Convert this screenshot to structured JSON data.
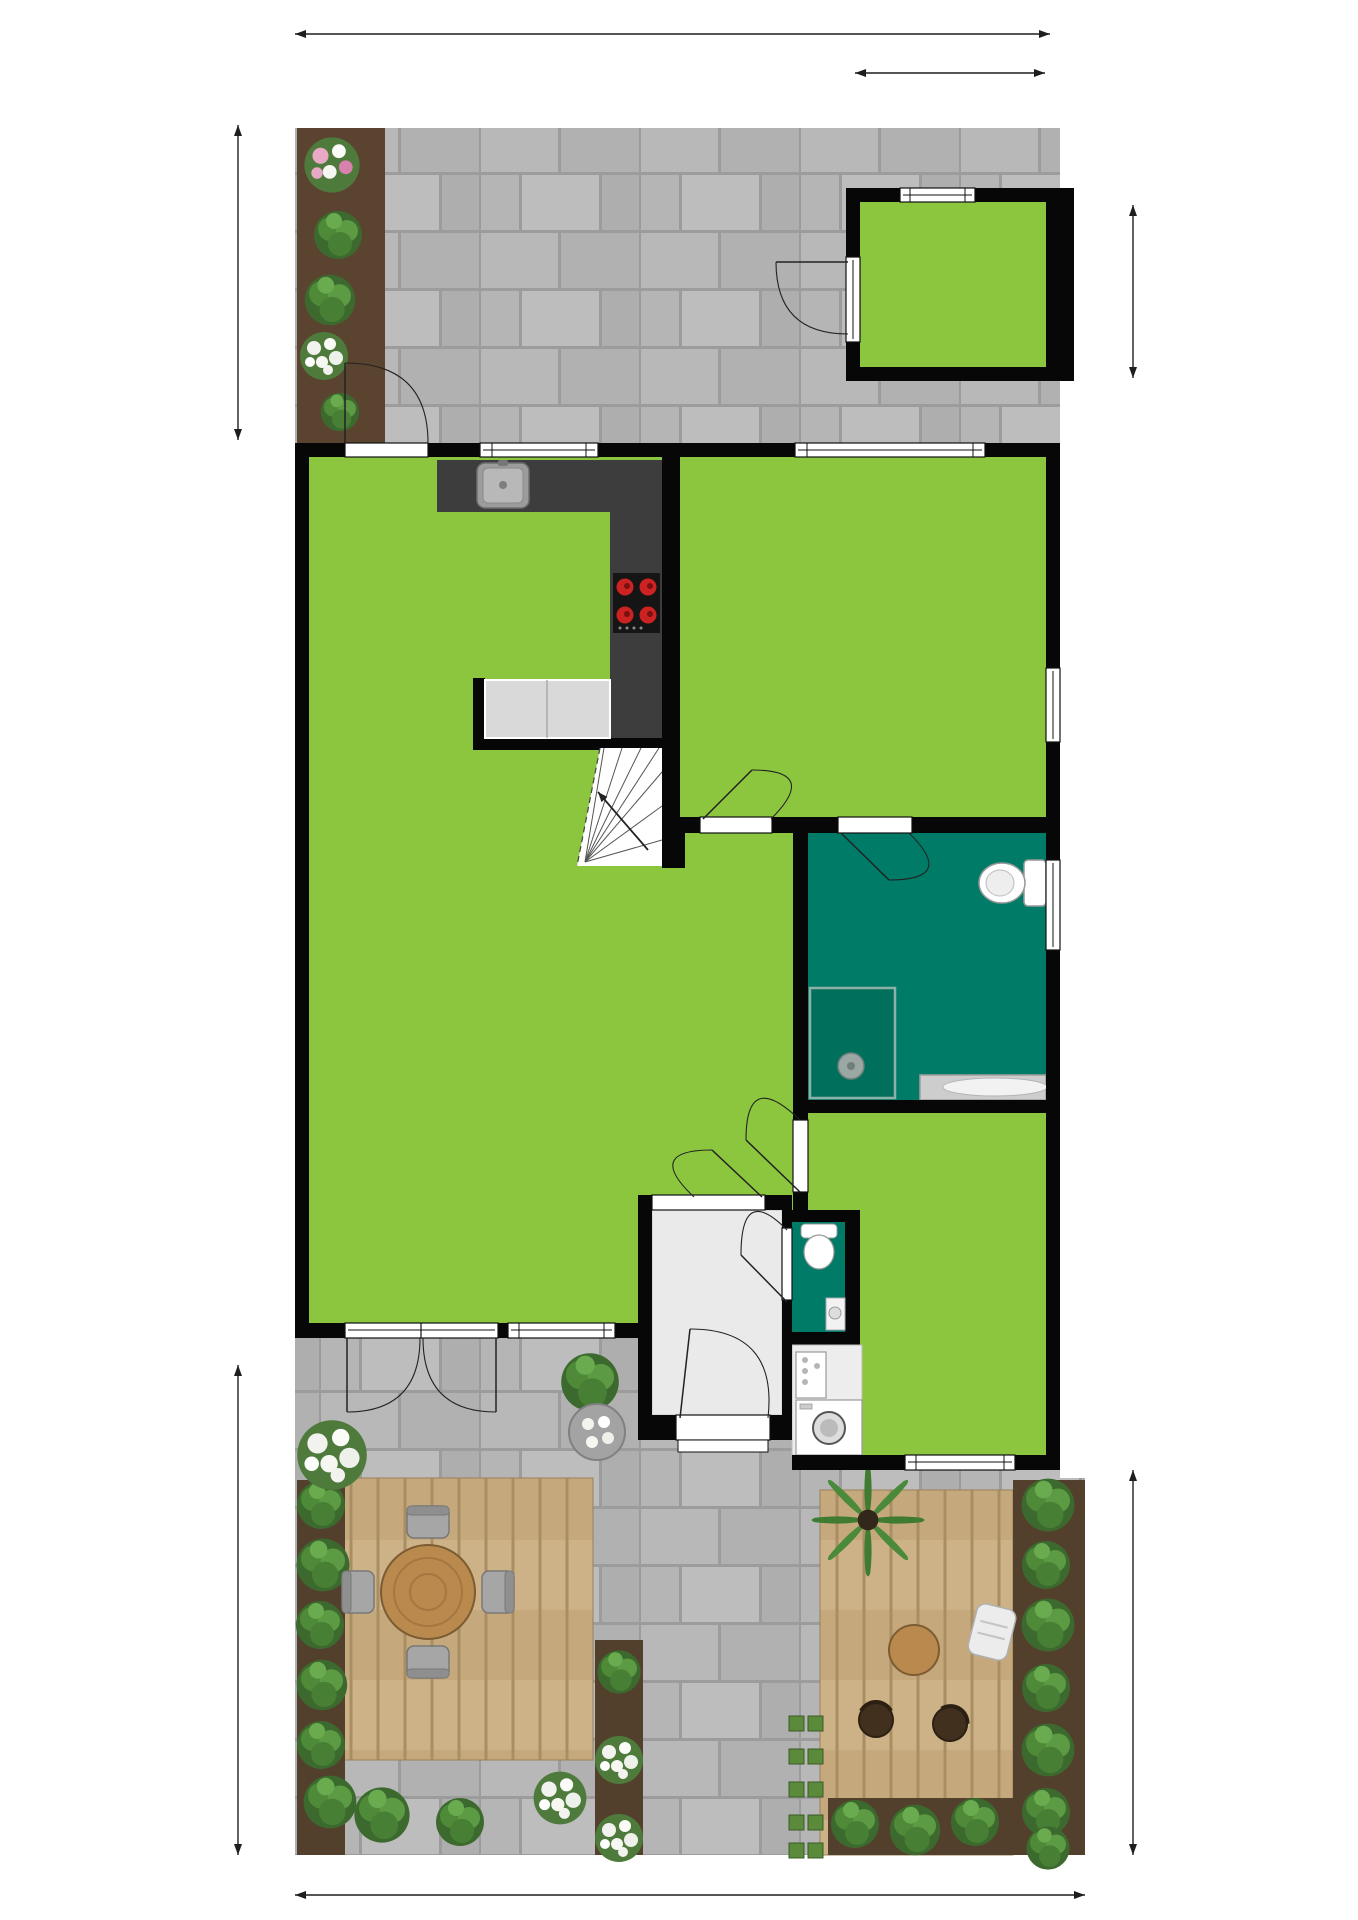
{
  "dimensions": {
    "top": "8.54 m",
    "berging_width": "2.10 m",
    "left_upper": "3.40 m",
    "berging_depth": "1.90 m",
    "left_lower": "5.24 m",
    "right_lower": "4.27 m",
    "bottom": "8.65 m"
  },
  "rooms": {
    "berging": {
      "name": "Berging",
      "area": "4.0 m²"
    },
    "keuken": {
      "name": "Keuken"
    },
    "slaapkamer": {
      "name": "Slaapkamer",
      "area": "16.5 m²"
    },
    "woonkamer": {
      "name": "Woonkamer",
      "area": "30.8 m²",
      "ceiling_height": "H = 2.61m"
    },
    "badkamer": {
      "name": "Badkamer",
      "area": "7.9 m²"
    },
    "entree": {
      "name": "Entree",
      "area": "3.4 m²"
    },
    "toilet": {
      "name": "Toilet",
      "area": "1.1 m²"
    },
    "bijkeuken": {
      "name": "Bijkeuken",
      "area": "7.6 m²"
    },
    "meterkast": {
      "abbr": "MK"
    }
  },
  "colors": {
    "room_green": "#8cc63f",
    "wet_room_teal": "#007b68",
    "wall_black": "#070707",
    "paving_gray": "#b5b5b5",
    "deck_wood": "#cdb287"
  }
}
